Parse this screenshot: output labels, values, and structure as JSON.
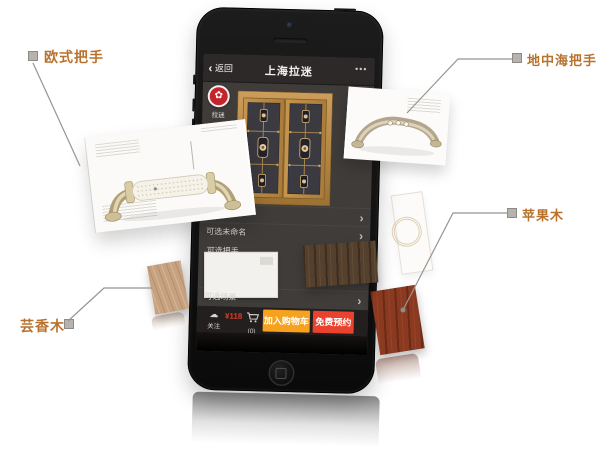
{
  "callouts": {
    "european": "欧式把手",
    "mediterranean": "地中海把手",
    "apple_wood": "苹果木",
    "rue_wood": "芸香木"
  },
  "phone_app": {
    "navbar": {
      "back_chevron": "‹",
      "back_label": "返回",
      "title": "上海拉迷",
      "menu_dots": "•••"
    },
    "brand": {
      "avatar_glyph": "✿",
      "avatar_label": "拉迷"
    },
    "list_rows": {
      "chevron": "›",
      "row_naming": "可选未命名",
      "row_handle": "可选把手",
      "row_scene": "可选场景"
    },
    "action_bar": {
      "follow_icon": "☁",
      "follow_label": "关注",
      "price_badge": "¥118",
      "cart_count": "(0)",
      "add_to_cart": "加入购物车",
      "free_booking": "免费预约"
    }
  },
  "colors": {
    "callout_text": "#b9722e",
    "add_to_cart_button": "#f6a21e",
    "free_booking_button": "#e9422e",
    "brand_avatar": "#c5242c",
    "cabinet_frame": "#bf8f4a"
  }
}
